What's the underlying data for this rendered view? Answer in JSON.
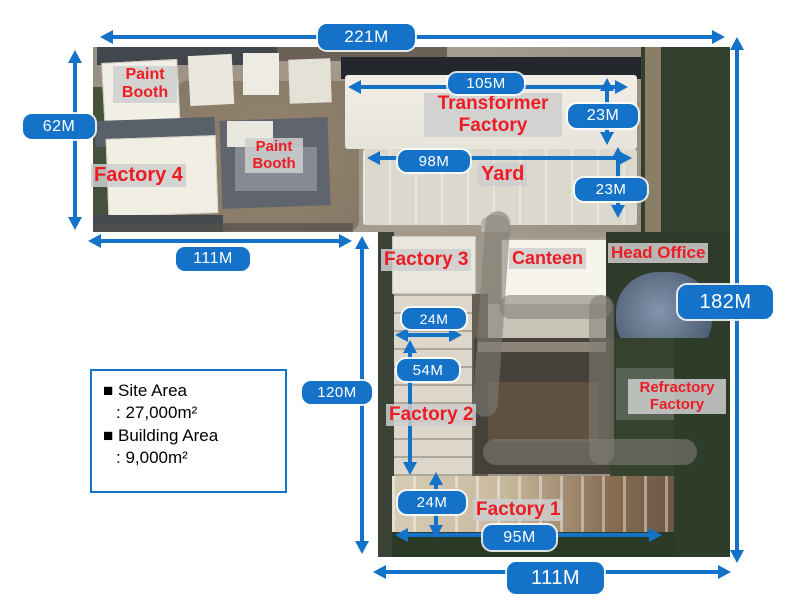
{
  "dimensions": {
    "site_width_top": "221M",
    "left_strip_height": "62M",
    "left_strip_width": "111M",
    "transformer_width": "105M",
    "transformer_depth": "23M",
    "yard_width": "98M",
    "yard_depth": "23M",
    "site_height_right": "182M",
    "factory2_width": "24M",
    "factory2_length": "54M",
    "lower_block_height": "120M",
    "factory1_depth": "24M",
    "factory1_width": "95M",
    "site_width_bottom": "111M"
  },
  "labels": {
    "paint_booth_1": "Paint Booth",
    "factory_4": "Factory 4",
    "paint_booth_2": "Paint Booth",
    "transformer_factory": "Transformer Factory",
    "yard": "Yard",
    "factory_3": "Factory 3",
    "canteen": "Canteen",
    "head_office": "Head Office",
    "refractory_factory": "Refractory Factory",
    "factory_2": "Factory 2",
    "factory_1": "Factory 1"
  },
  "legend": {
    "items": [
      {
        "label": "■ Site Area",
        "value": ": 27,000m²"
      },
      {
        "label": "■ Building Area",
        "value": ": 9,000m²"
      }
    ]
  },
  "colors": {
    "accent_blue": "#1473c8",
    "label_red": "#ed1c24",
    "label_background": "#cecece"
  }
}
